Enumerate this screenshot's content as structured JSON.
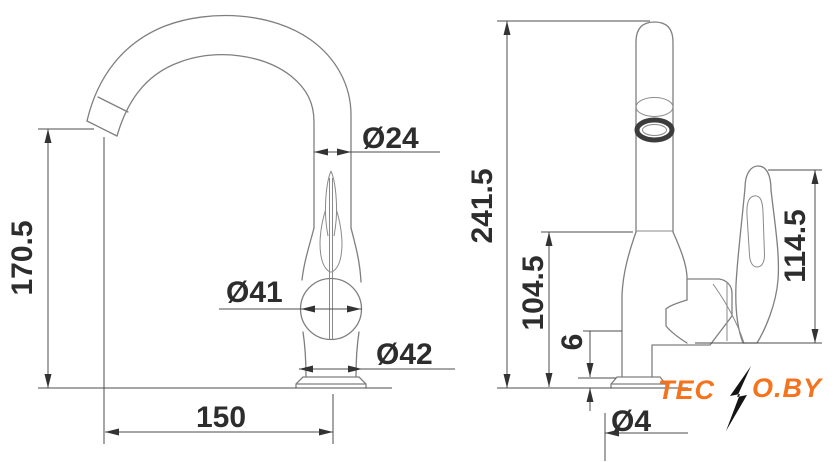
{
  "drawing": {
    "background": "#ffffff",
    "colors": {
      "outline": "#7f7f7f",
      "dimension_lines": "#4d4d4d",
      "dimension_text": "#2d2d2d"
    },
    "front_view": {
      "dims": {
        "spout_height": "170.5",
        "spout_diameter": "Ø24",
        "handle_diameter": "Ø41",
        "body_base_diameter": "Ø42",
        "reach": "150"
      }
    },
    "side_view": {
      "dims": {
        "overall_height": "241.5",
        "body_height": "104.5",
        "base_plate_thickness": "6",
        "lever_height": "114.5",
        "base_diameter_partial": "Ø4"
      }
    },
    "watermark": {
      "prefix": "TEC",
      "suffix": "O.BY",
      "color": "#F4731C",
      "bolt_color": "#141414"
    }
  }
}
